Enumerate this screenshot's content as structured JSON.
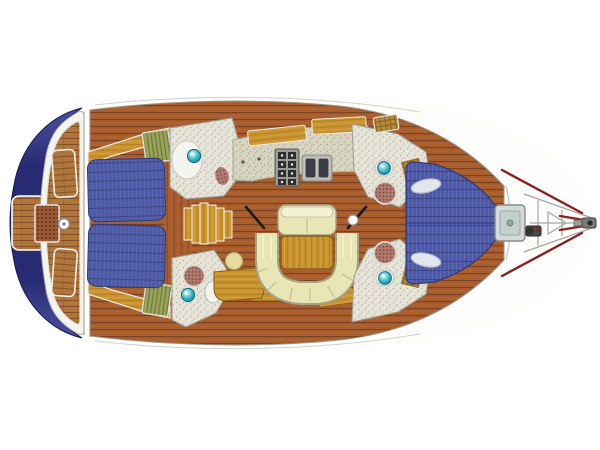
{
  "diagram": {
    "kind": "sailing-yacht-interior-layout-plan",
    "view": "top-down",
    "orientation": "bow-right-stern-left",
    "cabins": 3,
    "heads": 4,
    "berth_count": 3
  },
  "canvas": {
    "width": 600,
    "height": 450,
    "background": "#ffffff"
  },
  "colors": {
    "hull_fill": "#fdfdfb",
    "hull_line": "#8f8f8a",
    "sheer_line": "#c6c6c0",
    "navy": "#272c72",
    "navy_edge": "#171a4e",
    "navy_hi": "#4a50a0",
    "white_deck": "#f3f3ef",
    "bulkhead": "#aaaaa4",
    "berth_blue": "#4d59a4",
    "berth_rib": "#5d69b4",
    "berth_seam": "#39437e",
    "berth_border": "#2e3a7a",
    "sole_base": "#a75d2e",
    "sole_seam": "#7c4220",
    "sole_hi": "#c57436",
    "teak_base": "#b0763a",
    "teak_seam": "#855026",
    "gold": "#c9932f",
    "gold_dark": "#a9771c",
    "gold_hi": "#e0b050",
    "gold_border": "#8a5e14",
    "cream": "#e9e6b6",
    "cream_hi": "#f4f2d2",
    "cream_shadow": "#a5a288",
    "counter": "#d7d4c0",
    "counter_dot": "#a9a590",
    "head_floor": "#e6e4d8",
    "head_dot": "#b4b09c",
    "sink_teal": "#35b2c4",
    "sink_deep": "#13788c",
    "sink_light": "#e8fbfa",
    "rug": "#b07b6e",
    "rug_dot": "#7e4a3e",
    "toilet": "#a86358",
    "grate": "#9c5a34",
    "grate_dot": "#5a2e12",
    "green_locker": "#9aa35a",
    "green_line": "#6f7a38",
    "hatch_wood": "#b58a3c",
    "hatch_line": "#8a6220",
    "red_accent": "#8e1f1f",
    "metal": "#9a9a96",
    "appliance_dark": "#2e2e2e",
    "hatch_glass": "#c2cfce",
    "hatch_frame": "#d4dada",
    "pulpit_line": "#a6a6a2",
    "black_brace": "#1a1a1a"
  },
  "parts": [
    {
      "id": "swim-platform",
      "label": "swim-platform"
    },
    {
      "id": "cockpit",
      "label": "cockpit"
    },
    {
      "id": "steering-wheel",
      "label": "steering-wheel"
    },
    {
      "id": "cockpit-grate",
      "label": "cockpit-floor-grate"
    },
    {
      "id": "aft-cabin-port",
      "label": "aft-double-berth-port"
    },
    {
      "id": "aft-cabin-starboard",
      "label": "aft-double-berth-starboard"
    },
    {
      "id": "companionway-stairs",
      "label": "companionway-stairs"
    },
    {
      "id": "aft-head-port",
      "label": "aft-head-port"
    },
    {
      "id": "aft-head-starboard",
      "label": "aft-head-starboard"
    },
    {
      "id": "galley",
      "label": "galley"
    },
    {
      "id": "stove",
      "label": "gimbaled-stove"
    },
    {
      "id": "galley-sink",
      "label": "double-sink"
    },
    {
      "id": "salon-settee",
      "label": "u-shaped-settee"
    },
    {
      "id": "salon-table",
      "label": "salon-table"
    },
    {
      "id": "salon-bench",
      "label": "forward-facing-bench"
    },
    {
      "id": "nav-seat",
      "label": "nav-stool"
    },
    {
      "id": "nav-desk",
      "label": "chart-table"
    },
    {
      "id": "forward-head-port",
      "label": "forward-head-port"
    },
    {
      "id": "forward-head-starboard",
      "label": "forward-head-starboard"
    },
    {
      "id": "v-berth",
      "label": "forward-v-berth"
    },
    {
      "id": "deck-hatch",
      "label": "foredeck-hatch"
    },
    {
      "id": "windlass",
      "label": "anchor-windlass"
    },
    {
      "id": "bow-pulpit",
      "label": "bow-pulpit"
    }
  ]
}
